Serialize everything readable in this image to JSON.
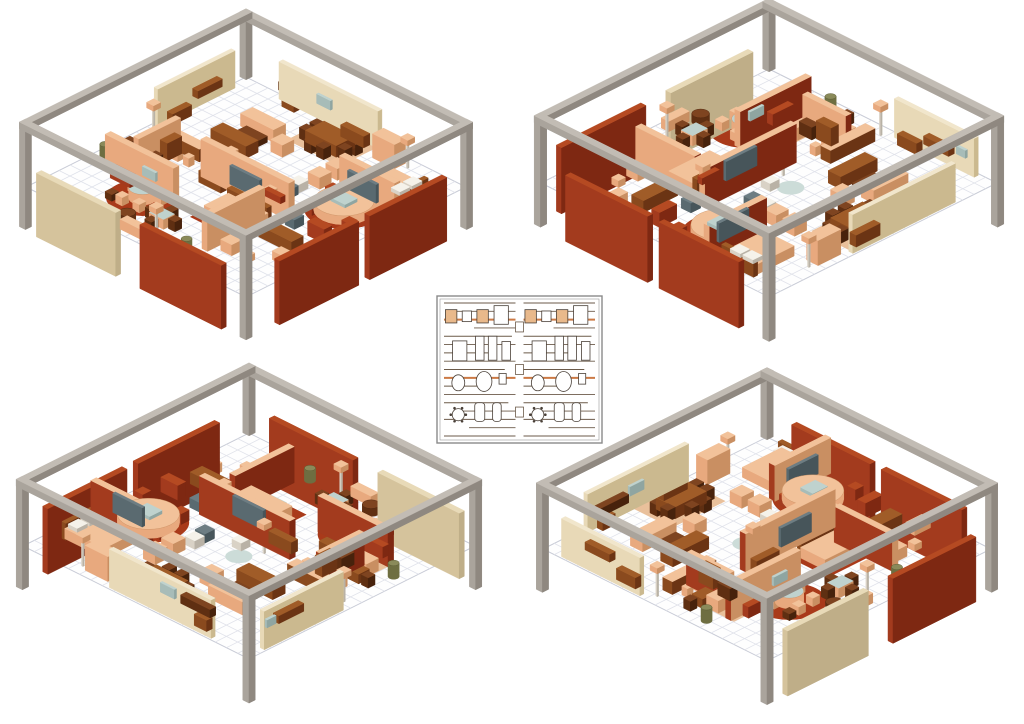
{
  "canvas": {
    "width": 1024,
    "height": 724,
    "background": "#ffffff"
  },
  "palette": {
    "frame": {
      "t": "#c2bcb4",
      "x": "#8f8880",
      "y": "#aaa49c"
    },
    "tanWall": {
      "t": "#f1e6cc",
      "x": "#cbb98f",
      "y": "#e8d9b7"
    },
    "beige": {
      "t": "#e8dab8",
      "x": "#bfae88",
      "y": "#d5c39c"
    },
    "redWall": {
      "t": "#b54a22",
      "x": "#7e2812",
      "y": "#a33b1e"
    },
    "salmon": {
      "t": "#f2c29a",
      "x": "#c98f62",
      "y": "#e8a97e"
    },
    "brown": {
      "t": "#a05c28",
      "x": "#6b3414",
      "y": "#8a4a1e"
    },
    "darkbrown": {
      "t": "#7e4420",
      "x": "#47220c",
      "y": "#5f2f12"
    },
    "slate": {
      "t": "#6d7d83",
      "x": "#47555a",
      "y": "#5a6a70"
    },
    "glass": {
      "t": "#bfd2ce",
      "x": "#8fa5a1",
      "y": "#a7bcb8"
    },
    "white": {
      "t": "#f5f2ea",
      "x": "#b9b2a6",
      "y": "#d9d2c6"
    },
    "olive": {
      "t": "#8a8a5a",
      "x": "#55552f",
      "y": "#6e6e41"
    }
  },
  "flat_colors": {
    "rugRed": "#a93a1a",
    "rugSalmon": "#e9c09b",
    "rugBlue": "#ccdcd8",
    "floorFill": "#fefefe",
    "floorEdge": "#c8cbd6",
    "gridLine": "#e0e2ea"
  },
  "room": {
    "size": 20,
    "grid_step": 1
  },
  "views": [
    {
      "id": "top-left",
      "cx": 246,
      "cy": 187,
      "rot": 0,
      "k": 11.0
    },
    {
      "id": "top-right",
      "cx": 769,
      "cy": 183,
      "rot": 270,
      "k": 11.4
    },
    {
      "id": "bottom-left",
      "cx": 249,
      "cy": 546,
      "rot": 180,
      "k": 11.3
    },
    {
      "id": "bottom-right",
      "cx": 767,
      "cy": 549,
      "rot": 90,
      "k": 11.2
    }
  ],
  "scene": {
    "rugs_rect": [
      [
        7.6,
        0.5,
        4.8,
        3.4,
        "rugSalmon"
      ],
      [
        10.2,
        11.7,
        4.8,
        3.6,
        "rugRed"
      ],
      [
        2.0,
        12.35,
        3.4,
        2.7,
        "rugSalmon"
      ]
    ],
    "rugs_round": [
      [
        6.3,
        15.7,
        2.35,
        "rugRed"
      ],
      [
        16.5,
        7.6,
        2.55,
        "rugRed"
      ],
      [
        9.5,
        8.6,
        0.85,
        "rugBlue"
      ]
    ],
    "walls": [
      [
        3.5,
        0.15,
        9.0,
        0.35,
        0,
        3.4,
        "tanWall"
      ],
      [
        0.15,
        1.5,
        0.35,
        7.0,
        0,
        3.4,
        "tanWall"
      ],
      [
        7.0,
        10.6,
        8.0,
        0.5,
        0,
        3.4,
        "salmon",
        {
          "f": {
            "nx": "redWall",
            "ny": "redWall"
          }
        }
      ],
      [
        2.0,
        14.3,
        6.2,
        0.5,
        0,
        3.2,
        "salmon",
        {
          "f": {
            "nx": "redWall",
            "ny": "redWall"
          }
        }
      ],
      [
        13.6,
        12.4,
        0.5,
        5.2,
        0,
        3.2,
        "salmon",
        {
          "f": {
            "nx": "redWall",
            "ny": "redWall"
          }
        }
      ],
      [
        3.2,
        9.6,
        0.45,
        3.8,
        0,
        2.9,
        "salmon",
        {
          "f": {
            "nx": "redWall",
            "ny": "redWall"
          }
        }
      ],
      [
        14.6,
        5.6,
        5.0,
        0.5,
        0,
        3.2,
        "salmon",
        {
          "f": {
            "nx": "redWall",
            "ny": "redWall"
          }
        }
      ]
    ],
    "panels": [
      [
        20.0,
        2.2,
        0.45,
        7.0,
        -3.6,
        5.8,
        "redWall"
      ],
      [
        20.0,
        10.2,
        0.45,
        7.2,
        -3.6,
        5.8,
        "redWall"
      ],
      [
        10.8,
        20.0,
        7.4,
        0.45,
        -3.6,
        5.8,
        "redWall"
      ],
      [
        1.4,
        20.0,
        7.2,
        0.45,
        -3.6,
        5.8,
        "beige"
      ]
    ],
    "frame_posts": [
      [
        -0.3,
        -0.3,
        0.55,
        0.55,
        0,
        5.9,
        "frame"
      ],
      [
        19.75,
        -0.3,
        0.55,
        0.55,
        0,
        5.9,
        "frame"
      ],
      [
        -0.3,
        19.75,
        0.55,
        0.55,
        0,
        5.9,
        "frame"
      ],
      [
        19.75,
        19.75,
        0.55,
        0.55,
        0,
        5.9,
        "frame"
      ]
    ],
    "frame_beams": [
      [
        -0.3,
        -0.3,
        20.6,
        0.55,
        5.3,
        0.6,
        "frame"
      ],
      [
        -0.3,
        19.75,
        20.6,
        0.55,
        5.3,
        0.6,
        "frame"
      ],
      [
        -0.3,
        -0.3,
        0.55,
        20.6,
        5.3,
        0.6,
        "frame"
      ],
      [
        19.75,
        -0.3,
        0.55,
        20.6,
        5.3,
        0.6,
        "frame"
      ]
    ],
    "attachments": [
      [
        4.0,
        0.55,
        2.6,
        0.5,
        1.35,
        0.75,
        "darkbrown"
      ],
      [
        4.3,
        0.55,
        1.1,
        0.5,
        0,
        1.0,
        "brown"
      ],
      [
        9.7,
        0.55,
        2.1,
        0.55,
        0,
        1.05,
        "brown"
      ],
      [
        7.1,
        0.5,
        1.25,
        0.18,
        1.5,
        0.85,
        "glass"
      ],
      [
        0.55,
        3.2,
        0.5,
        2.2,
        1.25,
        0.7,
        "brown"
      ],
      [
        0.55,
        6.0,
        0.5,
        1.7,
        0,
        1.0,
        "brown"
      ],
      [
        0.5,
        2.1,
        0.18,
        0.8,
        1.45,
        0.7,
        "glass"
      ],
      [
        9.9,
        11.15,
        2.7,
        0.22,
        0.9,
        1.7,
        "slate"
      ],
      [
        7.4,
        11.15,
        2.0,
        0.55,
        0,
        1.05,
        "brown"
      ],
      [
        13.2,
        11.15,
        1.5,
        0.4,
        1.6,
        0.6,
        "redWall"
      ],
      [
        3.0,
        14.85,
        1.8,
        0.5,
        0,
        1.0,
        "redWall"
      ],
      [
        5.6,
        14.85,
        1.2,
        0.18,
        1.4,
        0.8,
        "glass"
      ],
      [
        3.7,
        10.2,
        0.65,
        1.3,
        0.3,
        1.6,
        "brown"
      ],
      [
        3.7,
        11.9,
        0.65,
        1.1,
        0,
        1.1,
        "darkbrown"
      ],
      [
        15.6,
        6.15,
        2.6,
        0.22,
        0.8,
        1.7,
        "slate"
      ],
      [
        17.9,
        2.7,
        0.8,
        0.9,
        0.9,
        0.35,
        "white"
      ],
      [
        17.9,
        3.8,
        0.8,
        0.9,
        0.9,
        0.35,
        "white"
      ],
      [
        15.9,
        7.1,
        1.3,
        1.1,
        0.8,
        0.3,
        "glass"
      ]
    ],
    "furniture": [
      [
        8.6,
        1.5,
        2.8,
        1.7,
        0,
        1.05,
        "brown"
      ],
      [
        8.0,
        1.55,
        0.65,
        0.65,
        0,
        1.0,
        "darkbrown"
      ],
      [
        8.0,
        2.5,
        0.65,
        0.65,
        0,
        1.0,
        "darkbrown"
      ],
      [
        11.5,
        1.55,
        0.65,
        0.65,
        0,
        1.0,
        "darkbrown"
      ],
      [
        11.5,
        2.5,
        0.65,
        0.65,
        0,
        1.0,
        "darkbrown"
      ],
      [
        9.3,
        0.75,
        0.65,
        0.65,
        0,
        1.0,
        "darkbrown"
      ],
      [
        10.4,
        0.75,
        0.65,
        0.65,
        0,
        1.0,
        "darkbrown"
      ],
      [
        9.3,
        3.35,
        0.65,
        0.65,
        0,
        1.0,
        "darkbrown"
      ],
      [
        10.4,
        3.35,
        0.65,
        0.65,
        0,
        1.0,
        "darkbrown"
      ],
      [
        4.2,
        3.6,
        3.0,
        1.1,
        0,
        1.15,
        "salmon"
      ],
      [
        4.2,
        6.3,
        3.2,
        1.1,
        0,
        1.1,
        "brown"
      ],
      [
        5.0,
        4.95,
        1.9,
        0.85,
        0,
        0.55,
        "darkbrown"
      ],
      [
        7.9,
        4.6,
        1.05,
        1.05,
        0,
        1.1,
        "salmon"
      ],
      [
        13.1,
        0.6,
        2.0,
        1.0,
        0,
        2.2,
        "salmon"
      ],
      [
        15.3,
        2.5,
        3.5,
        2.6,
        0,
        0.9,
        "salmon"
      ],
      [
        18.6,
        2.4,
        0.35,
        2.8,
        0,
        1.5,
        "brown"
      ],
      [
        15.4,
        5.5,
        1.3,
        0.5,
        0,
        0.5,
        "darkbrown"
      ],
      [
        14.5,
        6.6,
        0.7,
        0.7,
        0,
        0.95,
        "redWall"
      ],
      [
        14.9,
        8.9,
        0.7,
        0.7,
        0,
        0.95,
        "redWall"
      ],
      [
        17.9,
        5.8,
        0.7,
        0.7,
        0,
        0.95,
        "redWall"
      ],
      [
        18.3,
        8.9,
        0.7,
        0.7,
        0,
        0.95,
        "redWall"
      ],
      [
        1.7,
        9.0,
        3.9,
        0.85,
        0,
        1.15,
        "brown",
        {
          "tc": "salmon"
        }
      ],
      [
        2.1,
        10.3,
        0.5,
        0.5,
        0,
        0.8,
        "salmon"
      ],
      [
        3.1,
        10.3,
        0.5,
        0.5,
        0,
        0.8,
        "salmon"
      ],
      [
        4.1,
        10.3,
        0.5,
        0.5,
        0,
        0.8,
        "salmon"
      ],
      [
        5.1,
        10.3,
        0.5,
        0.5,
        0,
        0.8,
        "salmon"
      ],
      [
        1.8,
        11.5,
        1.2,
        0.95,
        0,
        0.85,
        "brown"
      ],
      [
        1.0,
        11.55,
        0.6,
        0.6,
        0,
        0.9,
        "darkbrown"
      ],
      [
        3.2,
        11.55,
        0.6,
        0.6,
        0,
        0.9,
        "darkbrown"
      ],
      [
        2.1,
        12.5,
        2.9,
        1.05,
        0,
        1.1,
        "salmon"
      ],
      [
        5.3,
        12.5,
        1.0,
        1.0,
        0,
        1.05,
        "brown"
      ],
      [
        4.95,
        15.1,
        0.6,
        0.6,
        0,
        0.75,
        "salmon"
      ],
      [
        5.5,
        16.75,
        0.6,
        0.6,
        0,
        0.75,
        "salmon"
      ],
      [
        6.9,
        16.6,
        0.6,
        0.6,
        0,
        0.75,
        "salmon"
      ],
      [
        7.25,
        14.95,
        0.6,
        0.6,
        0,
        0.75,
        "salmon"
      ],
      [
        5.95,
        14.3,
        0.6,
        0.6,
        0,
        0.75,
        "salmon"
      ],
      [
        4.6,
        16.8,
        0.6,
        0.6,
        0,
        0.6,
        "darkbrown"
      ],
      [
        8.8,
        16.6,
        1.3,
        1.0,
        0,
        0.9,
        "salmon",
        {
          "tc": "glass"
        }
      ],
      [
        8.15,
        16.7,
        0.6,
        0.6,
        0,
        0.9,
        "darkbrown"
      ],
      [
        10.25,
        16.7,
        0.6,
        0.6,
        0,
        0.9,
        "darkbrown"
      ],
      [
        9.2,
        15.95,
        0.6,
        0.6,
        0,
        0.9,
        "darkbrown"
      ],
      [
        9.2,
        17.8,
        0.6,
        0.6,
        0,
        0.9,
        "darkbrown"
      ],
      [
        10.7,
        12.3,
        3.6,
        2.2,
        0,
        0.95,
        "salmon"
      ],
      [
        10.7,
        12.0,
        3.6,
        0.4,
        0,
        1.45,
        "brown"
      ],
      [
        11.7,
        14.2,
        1.3,
        0.8,
        0,
        0.5,
        "salmon",
        {
          "tc": "glass"
        }
      ],
      [
        15.1,
        12.9,
        3.0,
        1.05,
        0,
        1.05,
        "brown"
      ],
      [
        17.2,
        10.9,
        1.5,
        0.7,
        0,
        1.3,
        "redWall"
      ],
      [
        15.2,
        10.8,
        0.85,
        0.85,
        0,
        0.85,
        "slate"
      ],
      [
        17.8,
        14.6,
        1.4,
        0.8,
        0,
        0.8,
        "salmon"
      ],
      [
        16.4,
        16.2,
        0.6,
        0.6,
        0,
        0.6,
        "salmon"
      ],
      [
        14.6,
        15.9,
        1.0,
        1.0,
        0,
        1.0,
        "salmon"
      ],
      [
        12.5,
        4.2,
        1.05,
        1.05,
        0,
        1.05,
        "salmon"
      ],
      [
        12.5,
        5.8,
        1.05,
        1.05,
        0,
        1.05,
        "salmon"
      ],
      [
        12.1,
        7.3,
        0.85,
        0.85,
        0,
        0.75,
        "white"
      ],
      [
        9.9,
        9.2,
        0.8,
        0.8,
        0,
        0.7,
        "white"
      ],
      [
        12.2,
        8.3,
        0.85,
        0.85,
        0,
        0.8,
        "slate"
      ],
      [
        8.1,
        18.9,
        1.8,
        0.65,
        0,
        0.9,
        "salmon"
      ],
      [
        12.6,
        18.8,
        2.2,
        0.6,
        0,
        0.95,
        "brown"
      ]
    ],
    "cylinders": [
      [
        6.3,
        15.7,
        0.9,
        0,
        0.95,
        "salmon",
        "glass"
      ],
      [
        16.5,
        7.6,
        1.95,
        0,
        0.8,
        "salmon",
        "salmon"
      ],
      [
        7.6,
        18.4,
        0.55,
        0,
        0.7,
        "darkbrown",
        "darkbrown"
      ],
      [
        0.9,
        13.7,
        0.35,
        0,
        1.2,
        "olive",
        "olive"
      ],
      [
        13.1,
        18.5,
        0.35,
        0,
        1.1,
        "olive",
        "olive"
      ]
    ],
    "lamps": [
      [
        15.6,
        0.9
      ],
      [
        0.9,
        9.3
      ],
      [
        8.7,
        10.05
      ],
      [
        14.0,
        11.8
      ],
      [
        10.4,
        18.55
      ]
    ]
  },
  "floorplan": {
    "x": 437,
    "y": 296,
    "w": 165,
    "h": 147,
    "border_color": "#8a8a8a",
    "inner_border_color": "#9a9a9a",
    "line_color": "#6b5a49",
    "accent_color": "#cc7a45",
    "glyph_stroke": "#4a4038",
    "glyph_fill": "#ffffff",
    "glyph_accent_fill": "#e9b98b",
    "shelf_rows": 17,
    "accent_rows": [
      2,
      9
    ],
    "line_pattern": [
      1,
      0.88,
      1,
      0.58,
      0.95,
      1,
      0.7,
      1,
      0.85,
      1,
      0.6,
      1,
      0.9,
      0.75,
      1,
      0.65,
      1
    ],
    "connector_fracs": [
      0.18,
      0.5,
      0.82
    ],
    "glyphs": [
      {
        "t": "rect",
        "x": 0.1,
        "y": 0.1,
        "w": 0.16,
        "h": 0.1,
        "f": "a"
      },
      {
        "t": "rect",
        "x": 0.32,
        "y": 0.1,
        "w": 0.13,
        "h": 0.08
      },
      {
        "t": "rect",
        "x": 0.54,
        "y": 0.1,
        "w": 0.16,
        "h": 0.1,
        "f": "a"
      },
      {
        "t": "rect",
        "x": 0.8,
        "y": 0.09,
        "w": 0.2,
        "h": 0.14
      },
      {
        "t": "rect",
        "x": 0.22,
        "y": 0.36,
        "w": 0.2,
        "h": 0.15
      },
      {
        "t": "rect",
        "x": 0.5,
        "y": 0.34,
        "w": 0.12,
        "h": 0.18
      },
      {
        "t": "rect",
        "x": 0.68,
        "y": 0.34,
        "w": 0.12,
        "h": 0.18
      },
      {
        "t": "rect",
        "x": 0.87,
        "y": 0.36,
        "w": 0.12,
        "h": 0.14
      },
      {
        "t": "ell",
        "x": 0.2,
        "y": 0.6,
        "w": 0.18,
        "h": 0.12
      },
      {
        "t": "ell",
        "x": 0.56,
        "y": 0.59,
        "w": 0.22,
        "h": 0.15
      },
      {
        "t": "rect",
        "x": 0.82,
        "y": 0.57,
        "w": 0.1,
        "h": 0.08
      },
      {
        "t": "circ",
        "x": 0.2,
        "y": 0.84,
        "w": 0.17,
        "h": 0.17
      },
      {
        "t": "rrect",
        "x": 0.5,
        "y": 0.82,
        "w": 0.14,
        "h": 0.14
      },
      {
        "t": "rrect",
        "x": 0.74,
        "y": 0.82,
        "w": 0.12,
        "h": 0.14
      }
    ]
  }
}
